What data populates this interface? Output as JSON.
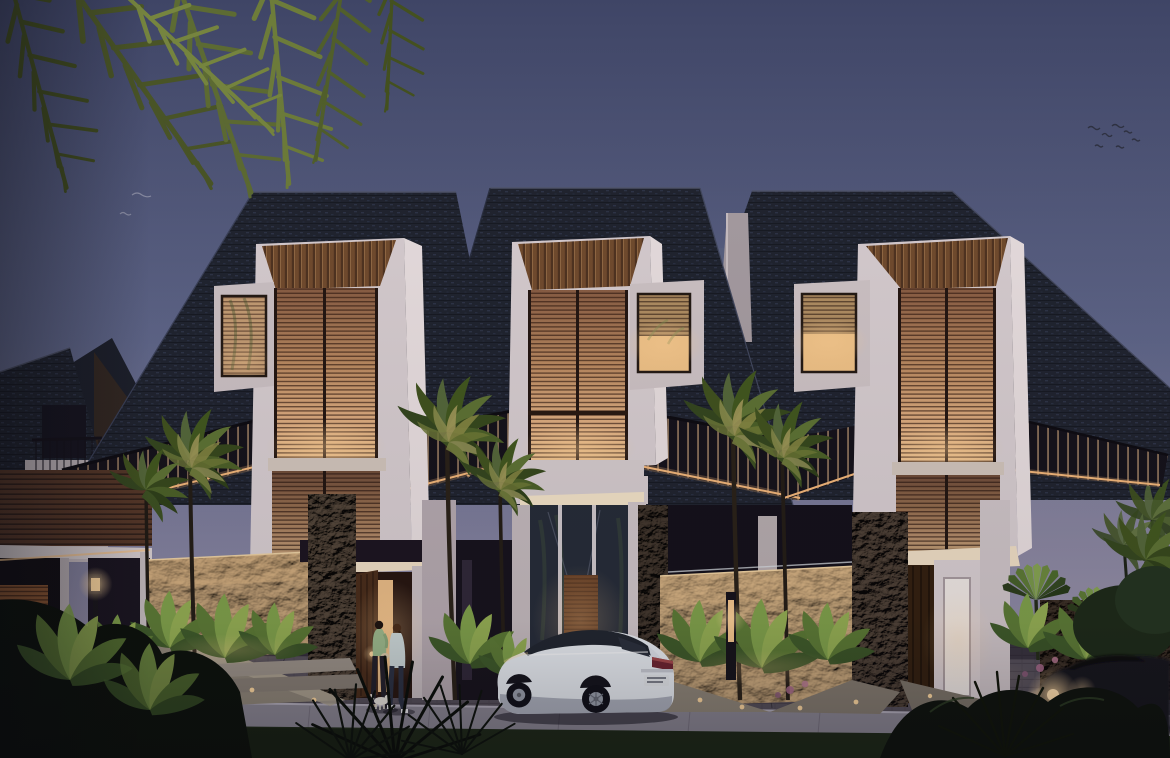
{
  "scene": {
    "type": "architectural-exterior-rendering",
    "description": "Dusk rendering of a row of three modern tropical two-storey townhouses with large dark shingle roofs, warm glowing timber louvre bays, coral stone walls, palm garden, a parked white sedan, a passing dark car with headlights on, and two pedestrians with a small dog at the left entrance",
    "time_of_day": "dusk",
    "setting": "tropical residential street"
  },
  "objects": {
    "townhouse_units": 3,
    "louvre_bays": 3,
    "lit_side_windows": 3,
    "entrance_doors": 3,
    "background_house": 1,
    "pedestrians": 2,
    "small_dog": 1,
    "parked_car": "white sedan, rear three-quarter view",
    "moving_car": "dark car, headlight glowing, motion blur",
    "street_lamp": 1,
    "bollard_light": 1,
    "palm_trees": 9,
    "banana_plant_clusters": 10,
    "bird_flock": "small flock upper right",
    "overhanging_palm_fronds": "top left corner"
  },
  "palette": {
    "sky_top": "#3f4566",
    "sky_mid": "#5f6689",
    "sky_horizon": "#a89cab",
    "roof_shingle": "#20242f",
    "roof_highlight": "#3a425c",
    "wall_white": "#ded4d6",
    "wall_white_lit": "#f3e3c8",
    "louvre_wood_dim": "#9a6c4e",
    "louvre_wood_glow": "#f0c490",
    "soffit_wood": "#8a5c39",
    "awning_dark": "#15121a",
    "accent_light_warm": "#ffd9a0",
    "stone_lit": "#c8a57a",
    "stone_dark": "#6a594a",
    "foliage_dark": "#0c110b",
    "foliage_mid": "#3c5226",
    "foliage_light": "#7d9148",
    "driveway_paver": "#554f59",
    "sidewalk": "#8b8793",
    "grass": "#1e2917",
    "car_white": "#eef0f4",
    "car_dark": "#15121a",
    "taillight_red": "#6e2430"
  }
}
